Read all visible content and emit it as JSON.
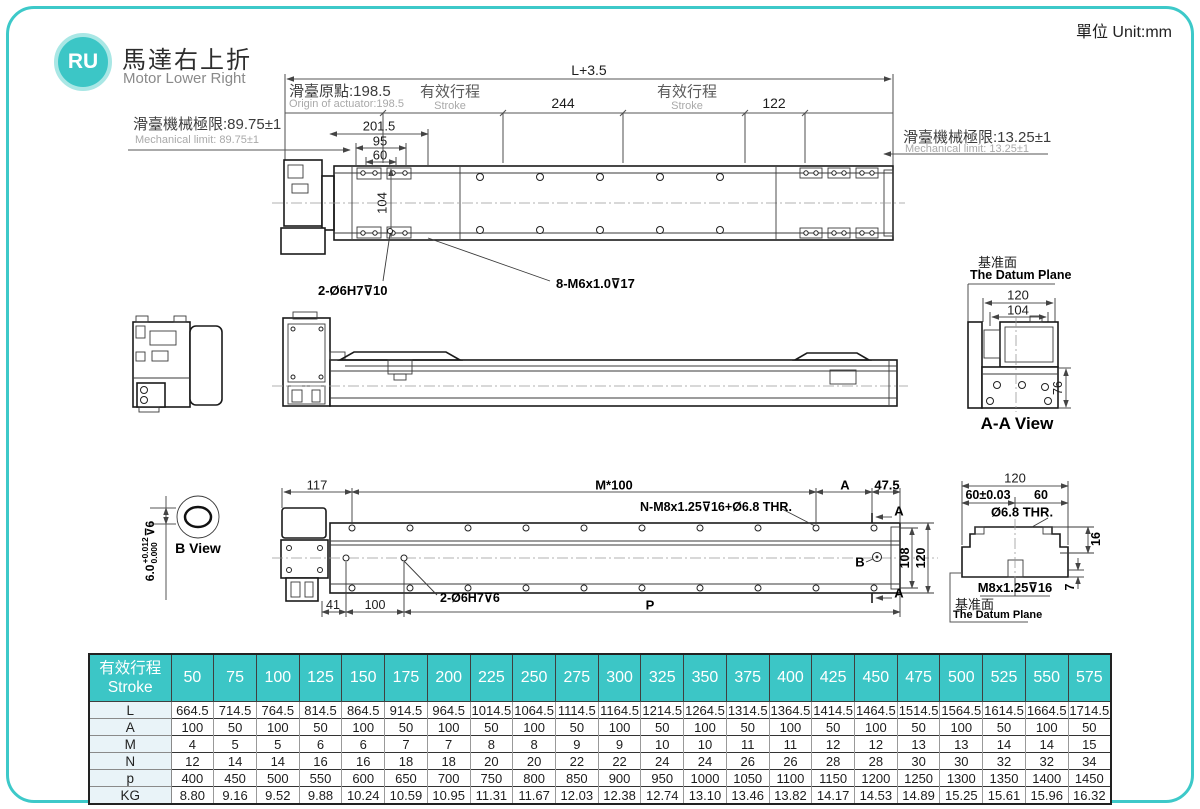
{
  "page": {
    "unit": "單位 Unit:mm",
    "accent": "#3cc6c6"
  },
  "header": {
    "badge": "RU",
    "title_zh": "馬達右上折",
    "title_en": "Motor Lower Right"
  },
  "top_view": {
    "dim_total": "L+3.5",
    "origin_zh": "滑臺原點:198.5",
    "origin_en": "Origin of actuator:198.5",
    "stroke_zh": "有效行程",
    "stroke_en": "Stroke",
    "dim_244": "244",
    "dim_122": "122",
    "limit_left_zh": "滑臺機械極限:89.75±1",
    "limit_left_en": "Mechanical limit: 89.75±1",
    "limit_right_zh": "滑臺機械極限:13.25±1",
    "limit_right_en": "Mechanical limit: 13.25±1",
    "dim_201_5": "201.5",
    "dim_95": "95",
    "dim_60": "60",
    "dim_104": "104",
    "note_dowel": "2-Ø6H7⊽10",
    "note_screws": "8-M6x1.0⊽17"
  },
  "aa_view": {
    "datum_zh": "基准面",
    "datum_en": "The Datum Plane",
    "dim_120": "120",
    "dim_104": "104",
    "dim_76": "76",
    "title": "A-A View"
  },
  "b_view": {
    "title": "B View",
    "tol_base": "6.0",
    "tol_plus": "+0.012",
    "tol_minus": "0.000",
    "tol_depth": "⊽6"
  },
  "bottom_view": {
    "dim_117": "117",
    "dim_pitch": "M*100",
    "mark_a": "A",
    "dim_47_5": "47.5",
    "note_screws": "N-M8x1.25⊽16+Ø6.8 THR.",
    "mark_b": "B",
    "dim_108": "108",
    "dim_120": "120",
    "note_dowel": "2-Ø6H7⊽6",
    "dim_41": "41",
    "dim_100": "100",
    "dim_p": "P"
  },
  "section_view": {
    "dim_120": "120",
    "dim_60tol": "60±0.03",
    "dim_60": "60",
    "note_thr": "Ø6.8 THR.",
    "note_tap": "M8x1.25⊽16",
    "dim_16": "16",
    "dim_7": "7",
    "datum_zh": "基准面",
    "datum_en": "The Datum Plane"
  },
  "table": {
    "header_zh": "有效行程",
    "header_en": "Stroke",
    "strokes": [
      "50",
      "75",
      "100",
      "125",
      "150",
      "175",
      "200",
      "225",
      "250",
      "275",
      "300",
      "325",
      "350",
      "375",
      "400",
      "425",
      "450",
      "475",
      "500",
      "525",
      "550",
      "575"
    ],
    "rows": [
      {
        "label": "L",
        "values": [
          "664.5",
          "714.5",
          "764.5",
          "814.5",
          "864.5",
          "914.5",
          "964.5",
          "1014.5",
          "1064.5",
          "1114.5",
          "1164.5",
          "1214.5",
          "1264.5",
          "1314.5",
          "1364.5",
          "1414.5",
          "1464.5",
          "1514.5",
          "1564.5",
          "1614.5",
          "1664.5",
          "1714.5"
        ]
      },
      {
        "label": "A",
        "values": [
          "100",
          "50",
          "100",
          "50",
          "100",
          "50",
          "100",
          "50",
          "100",
          "50",
          "100",
          "50",
          "100",
          "50",
          "100",
          "50",
          "100",
          "50",
          "100",
          "50",
          "100",
          "50"
        ]
      },
      {
        "label": "M",
        "values": [
          "4",
          "5",
          "5",
          "6",
          "6",
          "7",
          "7",
          "8",
          "8",
          "9",
          "9",
          "10",
          "10",
          "11",
          "11",
          "12",
          "12",
          "13",
          "13",
          "14",
          "14",
          "15"
        ]
      },
      {
        "label": "N",
        "values": [
          "12",
          "14",
          "14",
          "16",
          "16",
          "18",
          "18",
          "20",
          "20",
          "22",
          "22",
          "24",
          "24",
          "26",
          "26",
          "28",
          "28",
          "30",
          "30",
          "32",
          "32",
          "34"
        ]
      },
      {
        "label": "p",
        "values": [
          "400",
          "450",
          "500",
          "550",
          "600",
          "650",
          "700",
          "750",
          "800",
          "850",
          "900",
          "950",
          "1000",
          "1050",
          "1100",
          "1150",
          "1200",
          "1250",
          "1300",
          "1350",
          "1400",
          "1450"
        ]
      },
      {
        "label": "KG",
        "values": [
          "8.80",
          "9.16",
          "9.52",
          "9.88",
          "10.24",
          "10.59",
          "10.95",
          "11.31",
          "11.67",
          "12.03",
          "12.38",
          "12.74",
          "13.10",
          "13.46",
          "13.82",
          "14.17",
          "14.53",
          "14.89",
          "15.25",
          "15.61",
          "15.96",
          "16.32"
        ]
      }
    ]
  }
}
